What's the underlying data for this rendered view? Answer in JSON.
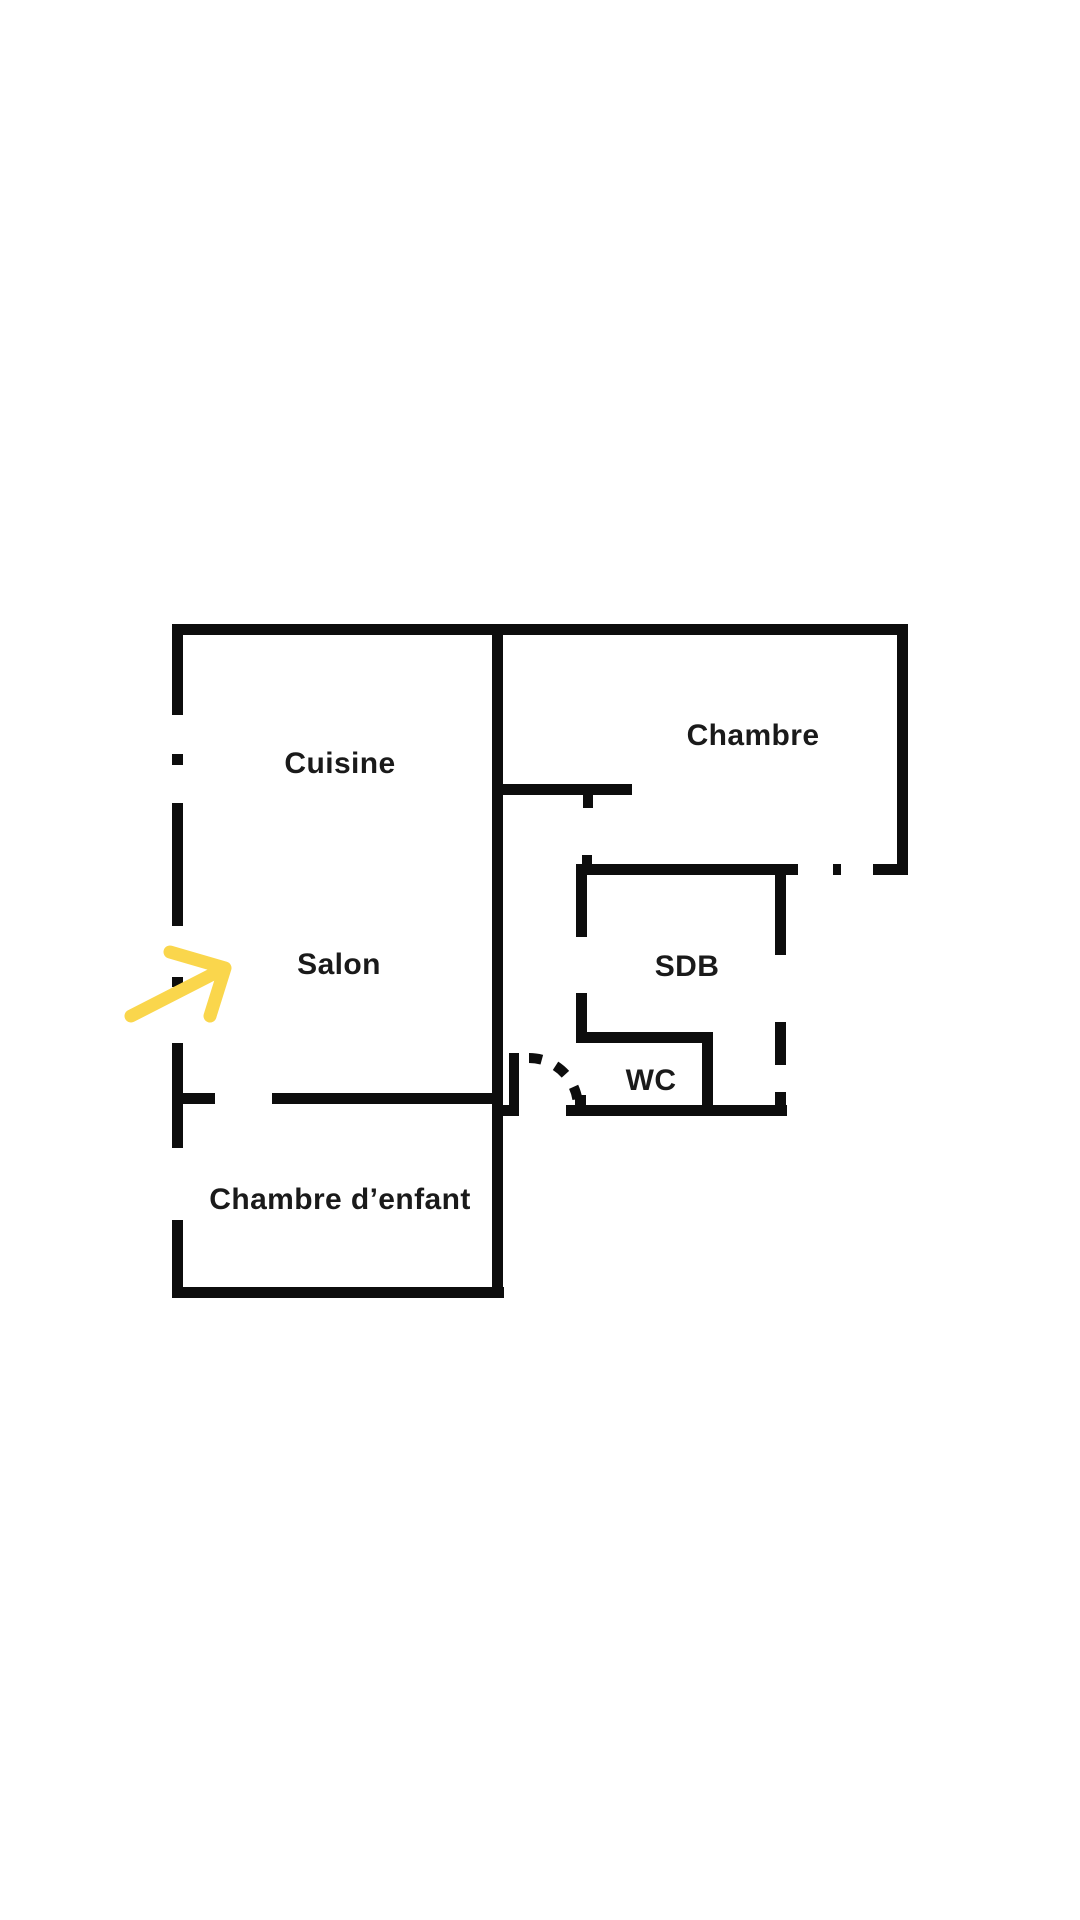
{
  "colors": {
    "background": "#ffffff",
    "wall": "#0d0d0d",
    "text": "#1a1a1a",
    "arrow": "#fad64c"
  },
  "floorplan": {
    "rooms": [
      {
        "id": "cuisine",
        "label": "Cuisine"
      },
      {
        "id": "chambre",
        "label": "Chambre"
      },
      {
        "id": "salon",
        "label": "Salon"
      },
      {
        "id": "sdb",
        "label": "SDB"
      },
      {
        "id": "wc",
        "label": "WC"
      },
      {
        "id": "chambre-enfant",
        "label": "Chambre d’enfant"
      }
    ],
    "walls": [
      {
        "name": "top-wall",
        "x": 172,
        "y": 624,
        "w": 736,
        "h": 11
      },
      {
        "name": "left-wall-seg-1",
        "x": 172,
        "y": 624,
        "w": 11,
        "h": 91
      },
      {
        "name": "left-wall-window-dash-1",
        "x": 172,
        "y": 754,
        "w": 11,
        "h": 11
      },
      {
        "name": "left-wall-seg-2",
        "x": 172,
        "y": 803,
        "w": 11,
        "h": 123
      },
      {
        "name": "left-wall-window-dash-2",
        "x": 172,
        "y": 977,
        "w": 11,
        "h": 10
      },
      {
        "name": "left-wall-seg-3",
        "x": 172,
        "y": 1043,
        "w": 11,
        "h": 105
      },
      {
        "name": "left-wall-seg-4",
        "x": 172,
        "y": 1220,
        "w": 11,
        "h": 78
      },
      {
        "name": "bottom-wall",
        "x": 172,
        "y": 1287,
        "w": 332,
        "h": 11
      },
      {
        "name": "central-wall",
        "x": 492,
        "y": 624,
        "w": 11,
        "h": 674
      },
      {
        "name": "salon-wall-stub",
        "x": 183,
        "y": 1093,
        "w": 32,
        "h": 11
      },
      {
        "name": "salon-wall-main",
        "x": 272,
        "y": 1093,
        "w": 220,
        "h": 11
      },
      {
        "name": "chambre-right-wall",
        "x": 897,
        "y": 624,
        "w": 11,
        "h": 251
      },
      {
        "name": "chambre-right-foot",
        "x": 873,
        "y": 864,
        "w": 35,
        "h": 11
      },
      {
        "name": "chambre-door-dash",
        "x": 833,
        "y": 864,
        "w": 8,
        "h": 11
      },
      {
        "name": "hall-wall",
        "x": 503,
        "y": 784,
        "w": 129,
        "h": 11
      },
      {
        "name": "hall-jamb-down",
        "x": 583,
        "y": 795,
        "w": 10,
        "h": 13
      },
      {
        "name": "sdb-top-jamb-up",
        "x": 582,
        "y": 855,
        "w": 10,
        "h": 10
      },
      {
        "name": "sdb-top-wall",
        "x": 576,
        "y": 864,
        "w": 222,
        "h": 11
      },
      {
        "name": "sdb-left-wall-upper",
        "x": 576,
        "y": 864,
        "w": 11,
        "h": 73
      },
      {
        "name": "sdb-left-wall-lower",
        "x": 576,
        "y": 993,
        "w": 11,
        "h": 50
      },
      {
        "name": "wc-top-wall",
        "x": 576,
        "y": 1032,
        "w": 137,
        "h": 11
      },
      {
        "name": "wc-right-wall",
        "x": 702,
        "y": 1032,
        "w": 11,
        "h": 84
      },
      {
        "name": "sdb-bottom-wall",
        "x": 566,
        "y": 1105,
        "w": 221,
        "h": 11
      },
      {
        "name": "sdb-bottom-left-stub",
        "x": 575,
        "y": 1095,
        "w": 11,
        "h": 10
      },
      {
        "name": "sdb-right-wall-seg-1",
        "x": 775,
        "y": 875,
        "w": 11,
        "h": 80
      },
      {
        "name": "sdb-right-wall-seg-2",
        "x": 775,
        "y": 1022,
        "w": 11,
        "h": 43
      },
      {
        "name": "sdb-right-wall-seg-3",
        "x": 775,
        "y": 1092,
        "w": 11,
        "h": 24
      },
      {
        "name": "wc-door-jamb",
        "x": 509,
        "y": 1053,
        "w": 10,
        "h": 63
      },
      {
        "name": "wc-door-jamb-foot",
        "x": 503,
        "y": 1105,
        "w": 16,
        "h": 11
      }
    ],
    "wc_door": {
      "path": "M 529 1058 A 49 49 0 0 1 578 1107"
    },
    "arrow": {
      "shaft_points": "131,1016 219,971",
      "head_points": "170,952 225,968 210,1016"
    }
  }
}
